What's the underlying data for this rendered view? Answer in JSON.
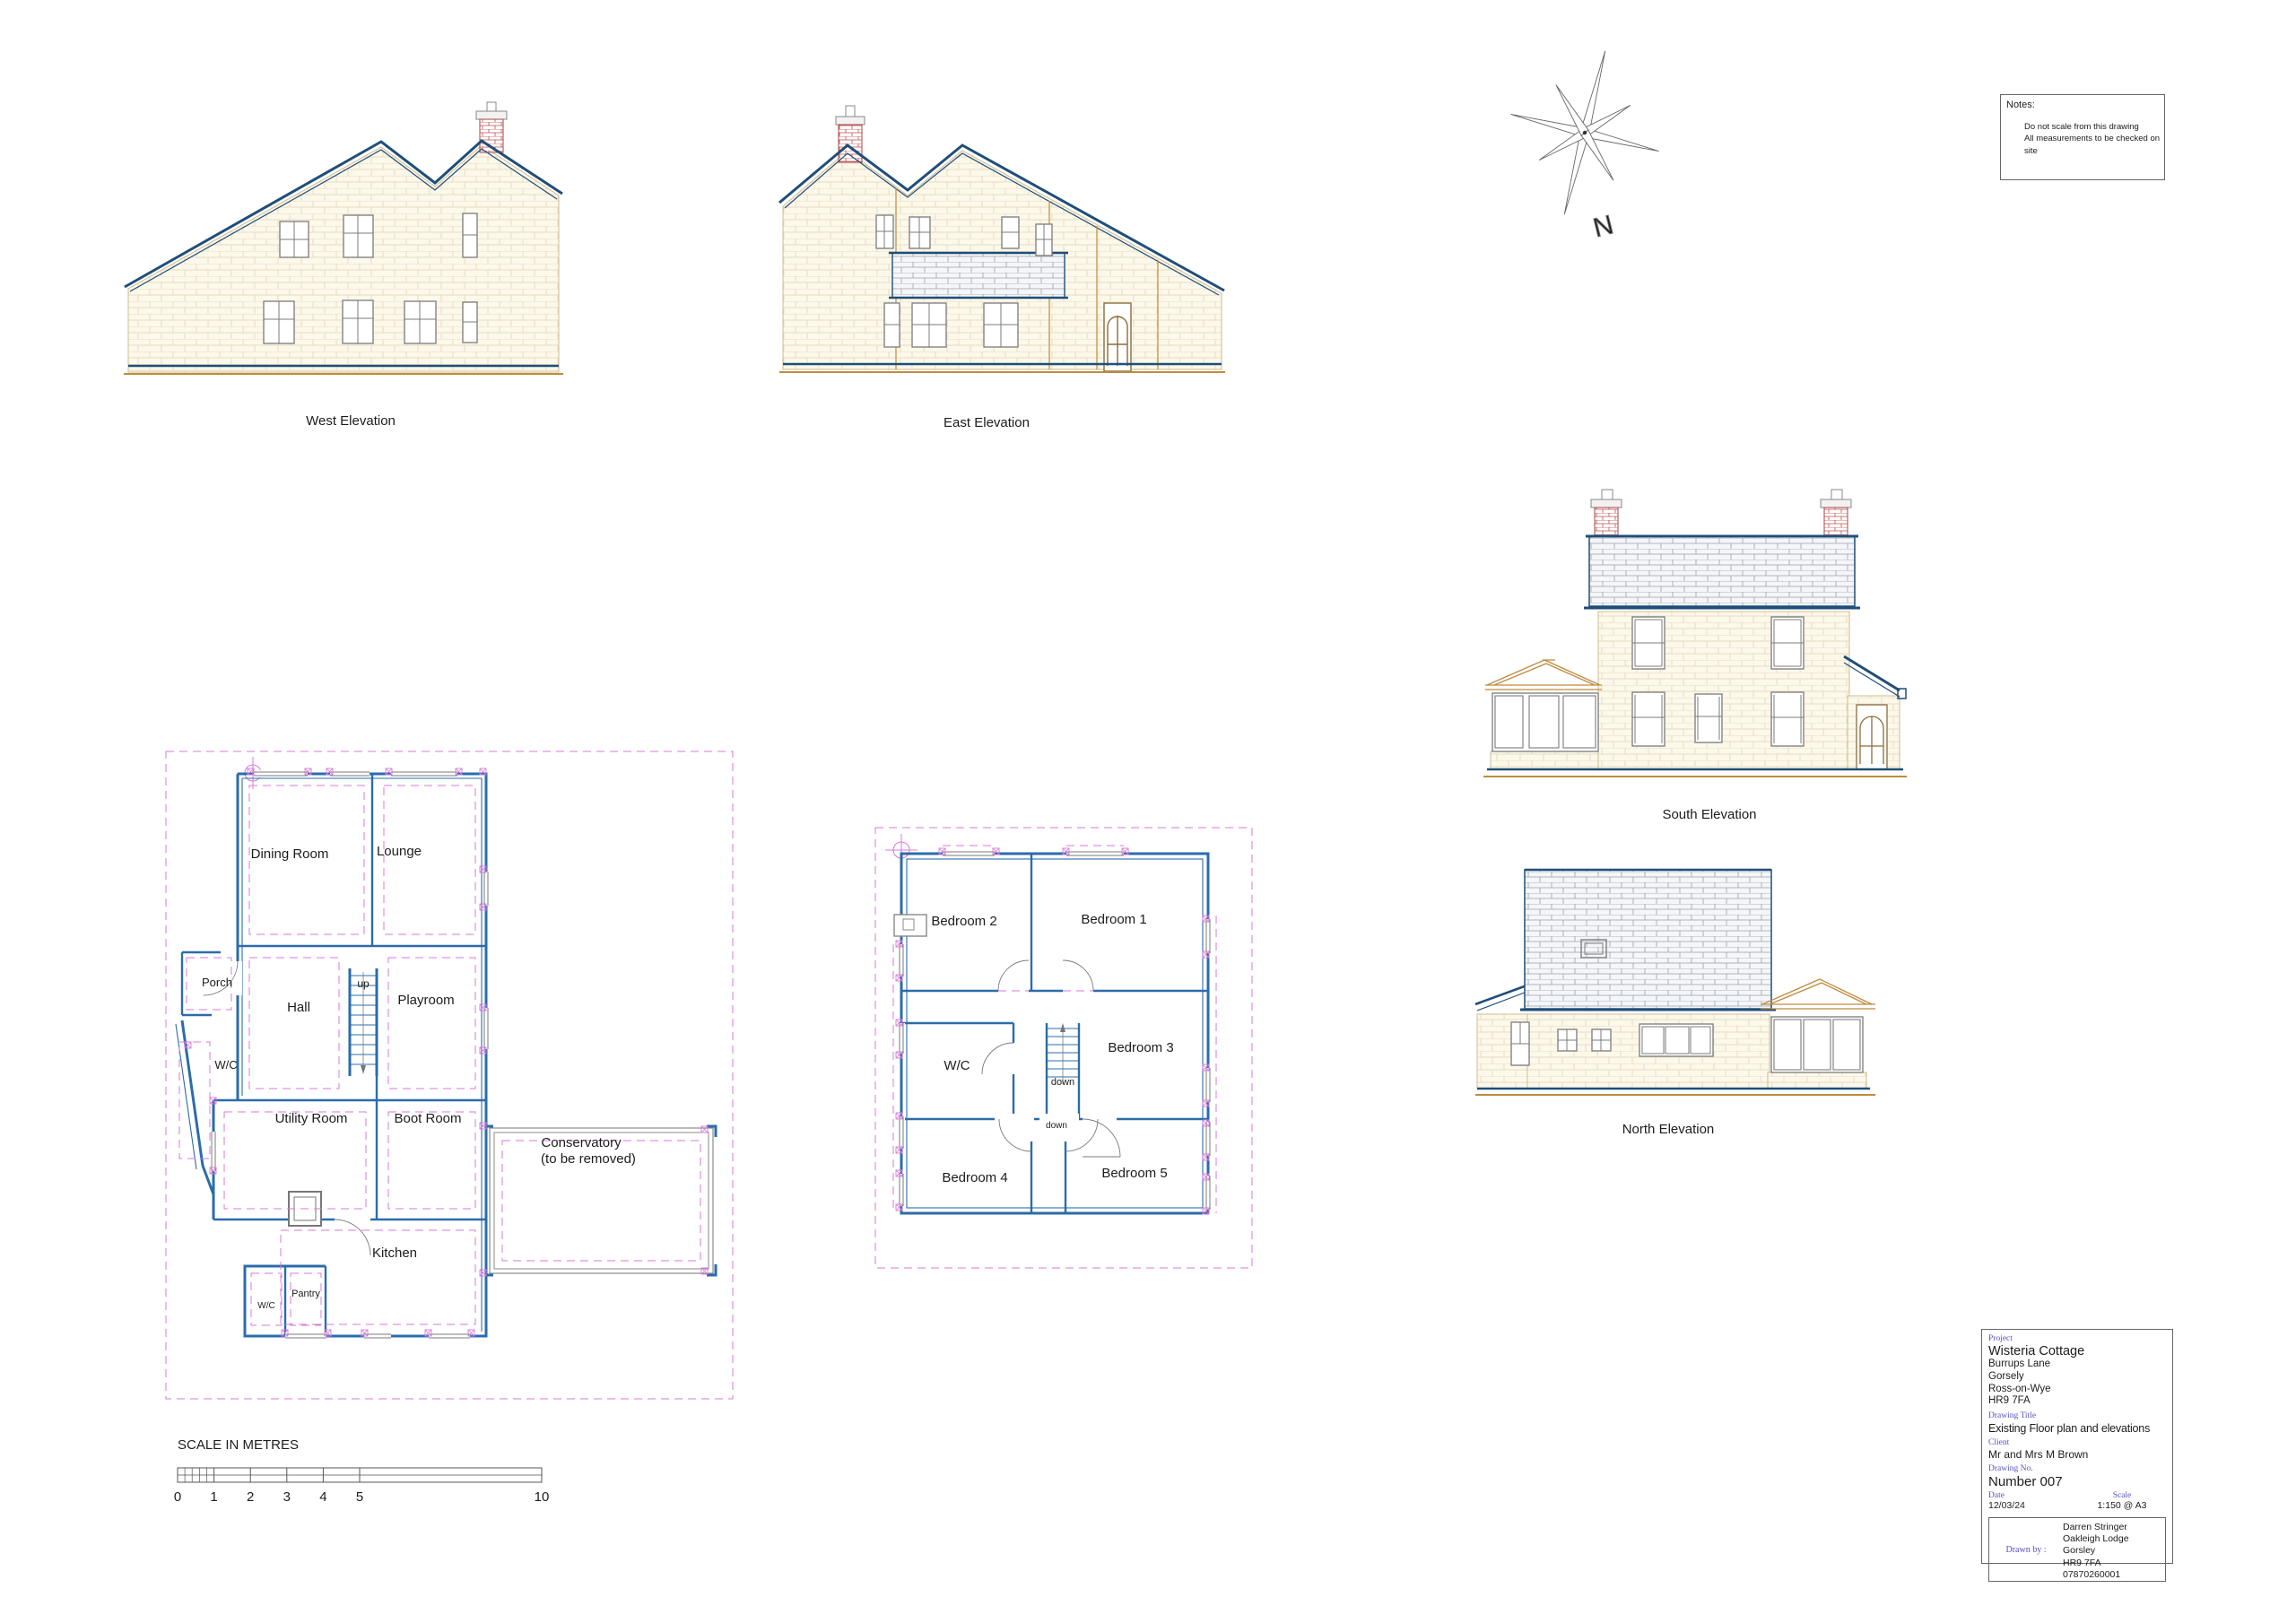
{
  "colors": {
    "roof_blue": "#1f4e79",
    "plan_wall_blue": "#2b6cab",
    "dashed_pink": "#d879d8",
    "brick_red": "#c0504d",
    "wall_cream": "#fcf8ea",
    "ground_tan": "#bf8b3e",
    "frame_gray": "#7b7b7b",
    "titleblock_label_blue": "#5552c0"
  },
  "elevations": {
    "west": {
      "label": "West Elevation"
    },
    "east": {
      "label": "East Elevation"
    },
    "south": {
      "label": "South Elevation"
    },
    "north": {
      "label": "North Elevation"
    }
  },
  "ground_floor": {
    "rooms": {
      "dining": "Dining Room",
      "lounge": "Lounge",
      "porch": "Porch",
      "hall": "Hall",
      "playroom": "Playroom",
      "wc": "W/C",
      "utility": "Utility Room",
      "boot": "Boot Room",
      "conservatory_line1": "Conservatory",
      "conservatory_line2": "(to be removed)",
      "kitchen": "Kitchen",
      "pantry": "Pantry",
      "wc_small": "W/C",
      "stair_up": "up"
    }
  },
  "first_floor": {
    "rooms": {
      "bedroom1": "Bedroom 1",
      "bedroom2": "Bedroom 2",
      "bedroom3": "Bedroom 3",
      "bedroom4": "Bedroom 4",
      "bedroom5": "Bedroom 5",
      "wc": "W/C",
      "stair_down1": "down",
      "stair_down2": "down"
    }
  },
  "compass": {
    "north_letter": "N"
  },
  "notes": {
    "title": "Notes:",
    "line1": "Do not scale from this drawing",
    "line2": "All measurements to be checked on site"
  },
  "scale_bar": {
    "title": "SCALE IN METRES",
    "ticks": [
      "0",
      "1",
      "2",
      "3",
      "4",
      "5",
      "10"
    ]
  },
  "title_block": {
    "project_label": "Project",
    "project_name": "Wisteria Cottage",
    "address_line1": "Burrups Lane",
    "address_line2": "Gorsely",
    "address_line3": "Ross-on-Wye",
    "address_line4": "HR9 7FA",
    "drawing_title_label": "Drawing Title",
    "drawing_title": "Existing Floor plan and elevations",
    "client_label": "Client",
    "client": "Mr and Mrs M Brown",
    "drawing_no_label": "Drawing No.",
    "drawing_no": "Number 007",
    "date_label": "Date",
    "date": "12/03/24",
    "scale_label": "Scale",
    "scale": "1:150 @ A3",
    "drawn_by_label": "Drawn by :",
    "drawn_by_line1": "Darren Stringer",
    "drawn_by_line2": "Oakleigh Lodge",
    "drawn_by_line3": "Gorsley",
    "drawn_by_line4": "HR9 7FA",
    "drawn_by_line5": "07870260001"
  }
}
